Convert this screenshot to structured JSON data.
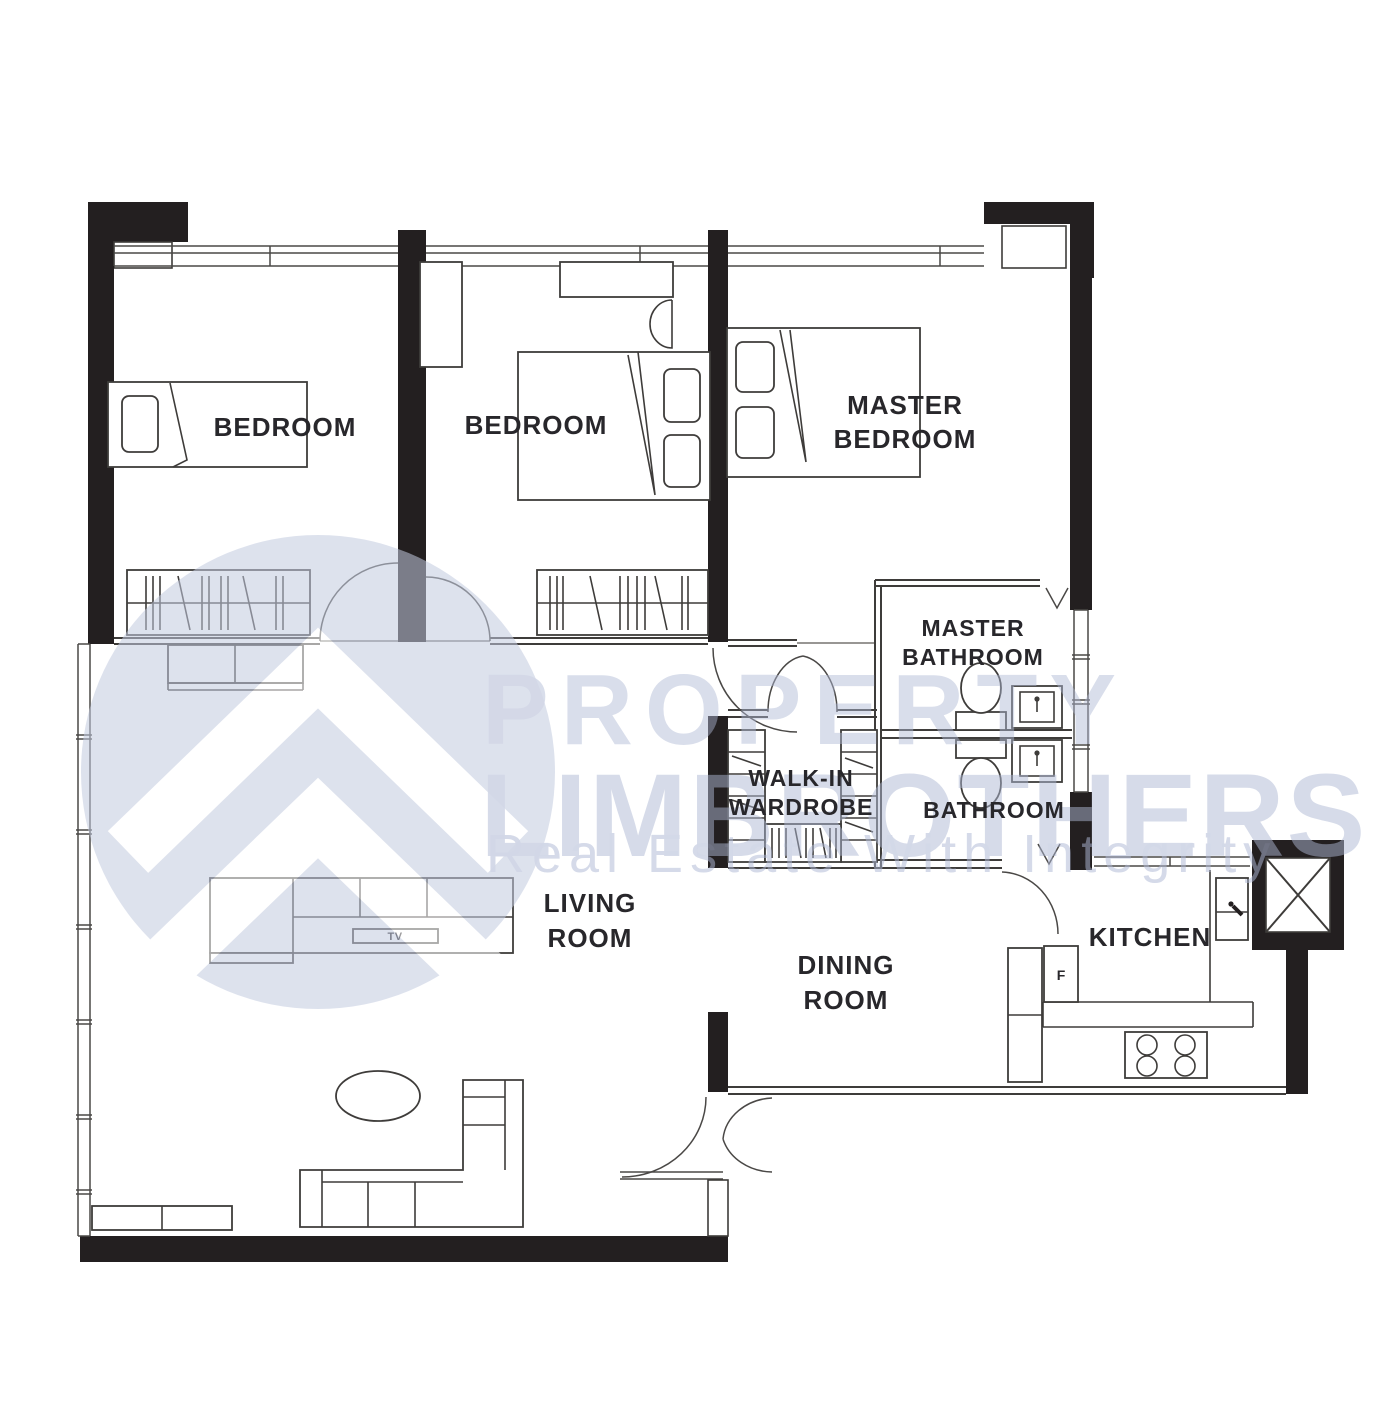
{
  "document": {
    "type": "apartment floor plan"
  },
  "watermark": {
    "brand_line1": "PROPERTY",
    "brand_line2": "LIMBROTHERS",
    "tagline": "Real Estate With Integrity"
  },
  "rooms": {
    "bedroom_1": {
      "label": "BEDROOM"
    },
    "bedroom_2": {
      "label": "BEDROOM"
    },
    "master_bedroom": {
      "line1": "MASTER",
      "line2": "BEDROOM"
    },
    "master_bathroom": {
      "line1": "MASTER",
      "line2": "BATHROOM"
    },
    "walk_in_wardrobe": {
      "line1": "WALK-IN",
      "line2": "WARDROBE"
    },
    "bathroom": {
      "label": "BATHROOM"
    },
    "living_room": {
      "line1": "LIVING",
      "line2": "ROOM"
    },
    "dining_room": {
      "line1": "DINING",
      "line2": "ROOM"
    },
    "kitchen": {
      "label": "KITCHEN"
    }
  },
  "appliances": {
    "tv": "TV",
    "fridge": "F"
  },
  "colors": {
    "wall": "#231f20",
    "thin_line": "#3e3c3a",
    "label_text": "#28272b",
    "watermark": "#aeb8d4",
    "background": "#ffffff"
  }
}
